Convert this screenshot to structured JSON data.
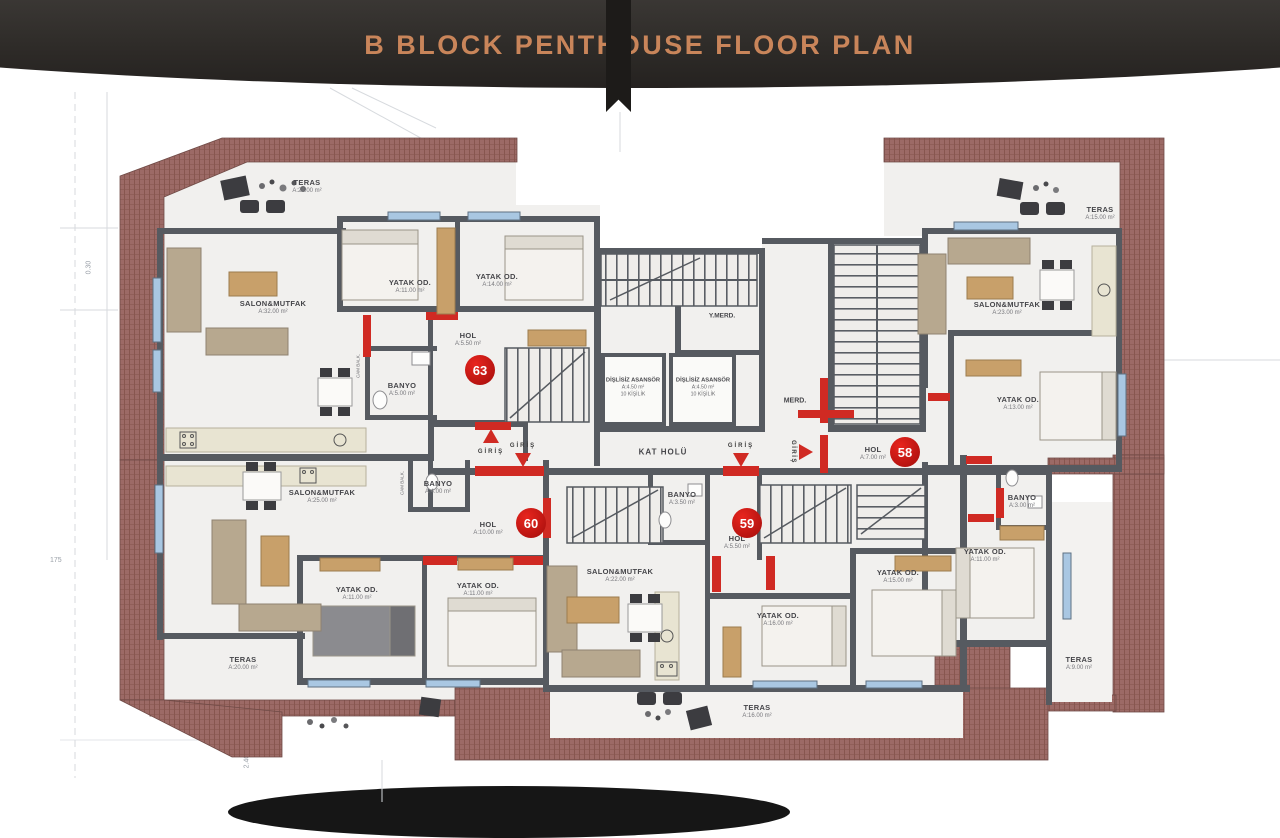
{
  "header": {
    "title": "B BLOCK PENTHOUSE FLOOR PLAN"
  },
  "underlay": {
    "dim_top": "0.30",
    "dim_left": "175",
    "dim_bottom": "2.40"
  },
  "core": {
    "elevator": {
      "name": "DİŞLİSİZ ASANSÖR",
      "area": "A:4.50 m²",
      "capacity": "10 KİŞİLİK"
    },
    "fire_stairs_label": "Y.MERD.",
    "stairs_label": "MERD.",
    "hall_label": "KAT HOLÜ",
    "entrance_label": "GİRİŞ"
  },
  "apartments": {
    "a63": {
      "no": "63",
      "teras": {
        "name": "TERAS",
        "area": "A:24.00 m²"
      },
      "salon": {
        "name": "SALON&MUTFAK",
        "area": "A:32.00 m²"
      },
      "yatak1": {
        "name": "YATAK OD.",
        "area": "A:11.00 m²"
      },
      "yatak2": {
        "name": "YATAK OD.",
        "area": "A:14.00 m²"
      },
      "hol": {
        "name": "HOL",
        "area": "A:5.50 m²"
      },
      "banyo": {
        "name": "BANYO",
        "area": "A:5.00 m²"
      },
      "cam_balk": "CAM BALK."
    },
    "a58": {
      "no": "58",
      "teras1": {
        "name": "TERAS",
        "area": "A:15.00 m²"
      },
      "salon": {
        "name": "SALON&MUTFAK",
        "area": "A:23.00 m²"
      },
      "yatak1": {
        "name": "YATAK OD.",
        "area": "A:13.00 m²"
      },
      "banyo": {
        "name": "BANYO",
        "area": "A:3.00 m²"
      },
      "yatak2": {
        "name": "YATAK OD.",
        "area": "A:11.00 m²"
      },
      "teras2": {
        "name": "TERAS",
        "area": "A:9.00 m²"
      },
      "hol": {
        "name": "HOL",
        "area": "A:7.00 m²"
      }
    },
    "a60": {
      "no": "60",
      "salon": {
        "name": "SALON&MUTFAK",
        "area": "A:25.00 m²"
      },
      "banyo": {
        "name": "BANYO",
        "area": "A:4.00 m²"
      },
      "hol": {
        "name": "HOL",
        "area": "A:10.00 m²"
      },
      "yatak1": {
        "name": "YATAK OD.",
        "area": "A:11.00 m²"
      },
      "yatak2": {
        "name": "YATAK OD.",
        "area": "A:11.00 m²"
      },
      "teras": {
        "name": "TERAS",
        "area": "A:20.00 m²"
      },
      "cam_balk": "CAM BALK."
    },
    "a59": {
      "no": "59",
      "salon": {
        "name": "SALON&MUTFAK",
        "area": "A:22.00 m²"
      },
      "banyo": {
        "name": "BANYO",
        "area": "A:3.50 m²"
      },
      "hol": {
        "name": "HOL",
        "area": "A:5.50 m²"
      },
      "yatak1": {
        "name": "YATAK OD.",
        "area": "A:16.00 m²"
      },
      "yatak2": {
        "name": "YATAK OD.",
        "area": "A:15.00 m²"
      },
      "teras": {
        "name": "TERAS",
        "area": "A:16.00 m²"
      }
    }
  },
  "colors": {
    "title": "#c9855a",
    "brick": "#9c6a66",
    "wall": "#565a60",
    "window": "#a9c7e2",
    "accent_red": "#d02a23",
    "unit_circle": "#c01312"
  }
}
